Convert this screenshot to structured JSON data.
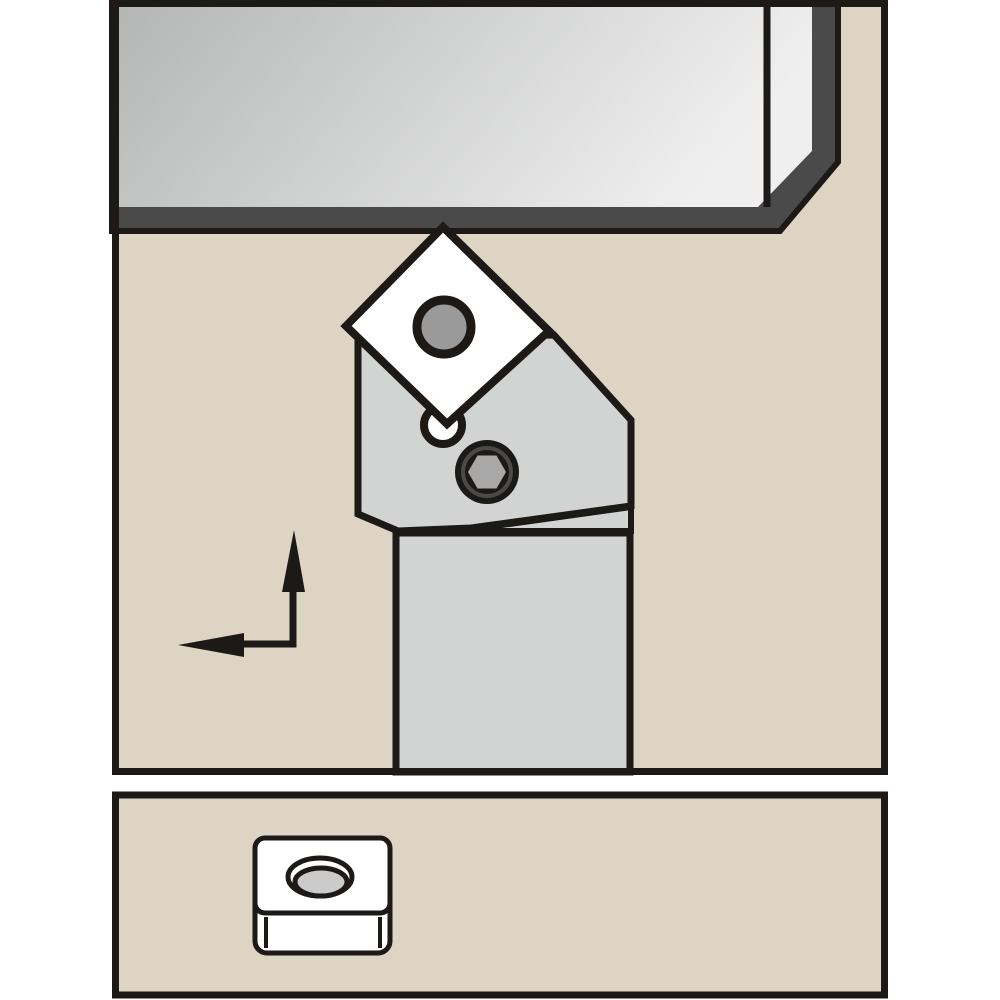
{
  "illustration": {
    "description": "Technical catalog illustration of a lathe turning toolholder holding a diamond-oriented square indexable insert cutting a round steel bar (top), with L-shaped feed-direction arrows pointing up and left; a separate lower panel shows the spare insert with a countersunk center hole.",
    "panels": {
      "main": "toolholder-cutting-view",
      "detail": "spare-insert-detail-view"
    }
  },
  "colors": {
    "page_bg": "#ffffff",
    "panel_bg": "#ddd4c3",
    "outline": "#1c1917",
    "workpiece_light": "#b4b6b5",
    "workpiece_lighter": "#eeefee",
    "workpiece_edge": "#4a4a4a",
    "holder": "#d2d4d3",
    "insert": "#ffffff",
    "insert_hole": "#9a9a9a",
    "screw_ring": "#4a4a4a",
    "screw_hex": "#a8a8a8",
    "spare_hole_inner": "#cbcbcb"
  },
  "shapes": {
    "main_panel_bg": {
      "x": 112,
      "y": 0,
      "width": 776,
      "height": 775
    },
    "main_panel_border": {
      "x": 115.5,
      "y": 3.5,
      "width": 769,
      "height": 768
    },
    "workpiece": {
      "outer_points": "112,0 838,0 838,162 780,231 112,231",
      "face_points": "119,4 812,4 812,151 758,207 119,207",
      "divider": {
        "x1": 767,
        "y1": 2,
        "x2": 767,
        "y2": 207
      }
    },
    "toolholder": {
      "shank_points": "396,533 630,533 630,772 396,772",
      "seat_points": "459,531 631,507 631,531",
      "head_points": "358,337 554,335 631,420 631,506 471,528 398,531 358,514",
      "relief_hole": {
        "cx": 443,
        "cy": 425,
        "r": 19
      }
    },
    "insert": {
      "diamond_points": "443,227 549,331 447,424 346,326",
      "hole": {
        "cx": 444,
        "cy": 327,
        "r": 27
      }
    },
    "screw": {
      "disc": {
        "cx": 487,
        "cy": 472,
        "r": 32
      },
      "counterbore": {
        "cx": 487,
        "cy": 472,
        "r": 24
      },
      "hex_points": "506,472 496.5,488.5 477.5,488.5 468,472 477.5,455.5 496.5,455.5"
    },
    "feed_arrow": {
      "elbow_d": "M293,591 L293,644 L244,644",
      "up_head_points": "294,530 305,592 282,592",
      "left_head_points": "178,645 244,633 244,657"
    },
    "detail_panel": {
      "x": 115.5,
      "y": 795,
      "width": 769,
      "height": 200
    },
    "spare_insert": {
      "side_face": {
        "x": 255,
        "y": 870,
        "width": 135,
        "height": 83,
        "rx": 12
      },
      "top_face": {
        "x": 255,
        "y": 838,
        "width": 135,
        "height": 75,
        "rx": 10
      },
      "left_edge": {
        "x1": 266,
        "y1": 917,
        "x2": 266,
        "y2": 948
      },
      "right_edge": {
        "x1": 380,
        "y1": 917,
        "x2": 380,
        "y2": 948
      },
      "hole_outer": {
        "cx": 320,
        "cy": 877,
        "rx": 32,
        "ry": 19
      },
      "hole_inner": {
        "cx": 321,
        "cy": 882,
        "rx": 26,
        "ry": 14
      }
    }
  }
}
